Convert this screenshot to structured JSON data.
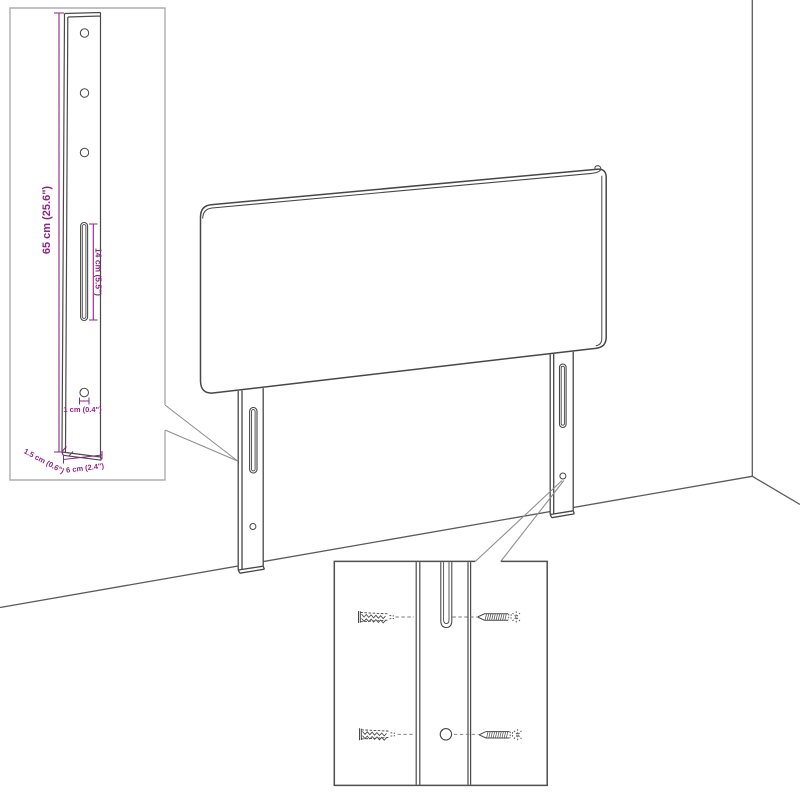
{
  "diagram": {
    "background": "#ffffff",
    "colors": {
      "furniture_line": "#474747",
      "wall_line": "#5a5a5a",
      "leader_line": "#8f8f8f",
      "dimension": "#8e2585",
      "detail_box_light": "#aeaeae",
      "detail_box_dark": "#4f4f4f"
    },
    "leg_detail": {
      "height_label": "65 cm (25.6\")",
      "slot_label": "14 cm (5.5\")",
      "hole_label": "1 cm (0.4\")",
      "depth_label": "1.5 cm (0.6\")",
      "width_label": "6 cm (2.4\")"
    },
    "mounting_detail": {
      "parts": [
        "wall-plug-icon",
        "screw-icon",
        "mounting-slot",
        "mounting-hole"
      ]
    }
  }
}
